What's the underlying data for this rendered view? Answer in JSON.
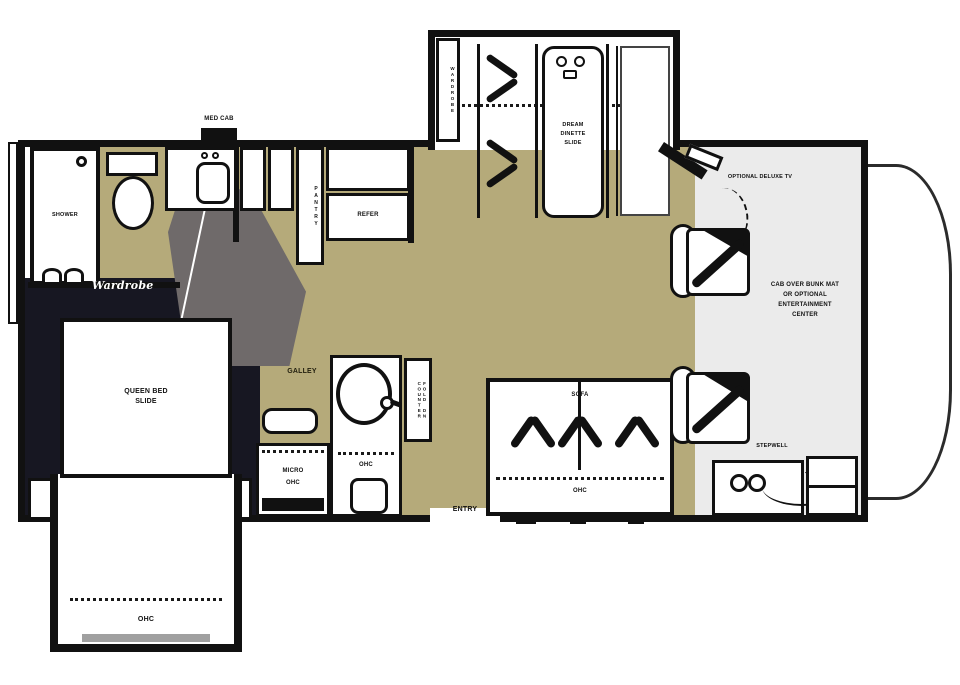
{
  "labels": {
    "shower": "SHOWER",
    "med_cab": "MED CAB",
    "wardrobe_script": "Wardrobe",
    "queen_bed_line1": "QUEEN BED",
    "queen_bed_line2": "SLIDE",
    "ohc": "OHC",
    "pantry": "PANTRY",
    "refer": "REFER",
    "galley": "GALLEY",
    "micro": "MICRO",
    "fold_counter": "FOLD DN COUNTER",
    "entry": "ENTRY",
    "sofa": "SOFA",
    "dinette_line1": "DREAM",
    "dinette_line2": "DINETTE",
    "dinette_line3": "SLIDE",
    "wardrobe_dinette": "WARDROBE",
    "optional_tv": "OPTIONAL DELUXE TV",
    "bunk_line1": "CAB OVER BUNK MAT",
    "bunk_line2": "OR OPTIONAL",
    "bunk_line3": "ENTERTAINMENT",
    "bunk_line4": "CENTER"
  },
  "labels2": {
    "stepwell": "STEPWELL"
  },
  "colors": {
    "wall": "#111111",
    "floor_tan": "#b5aa7a",
    "bedroom_dark": "#171722",
    "door_swing_gray": "#6f6a6a",
    "front_lounge_gray": "#ebebeb",
    "slide_trim_gray": "#a0a0a0"
  }
}
